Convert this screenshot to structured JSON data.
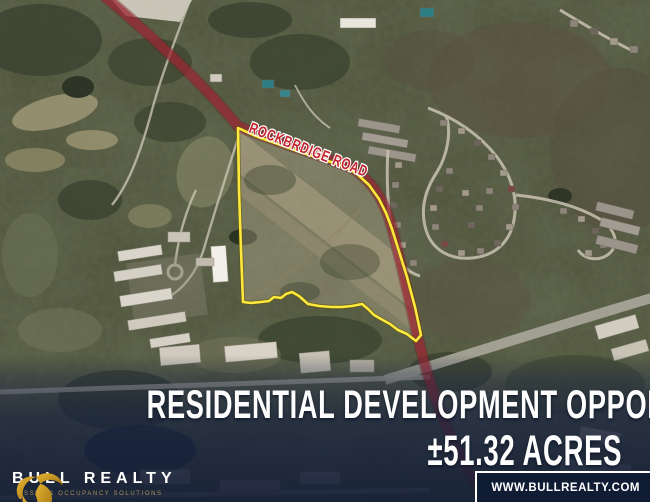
{
  "map": {
    "road_label": "ROCKBRDIGE ROAD",
    "colors": {
      "parcel_outline": "#ffe83d",
      "road_highlight": "#a32836",
      "road_label": "#c4242e"
    }
  },
  "headline": {
    "line1": "RESIDENTIAL DEVELOPMENT OPPORTUNITY",
    "line2": "±51.32 ACRES"
  },
  "brand": {
    "name": "BULL REALTY",
    "tagline": "ASSET & OCCUPANCY SOLUTIONS",
    "website": "WWW.BULLREALTY.COM",
    "gold": "#d3a02a"
  }
}
